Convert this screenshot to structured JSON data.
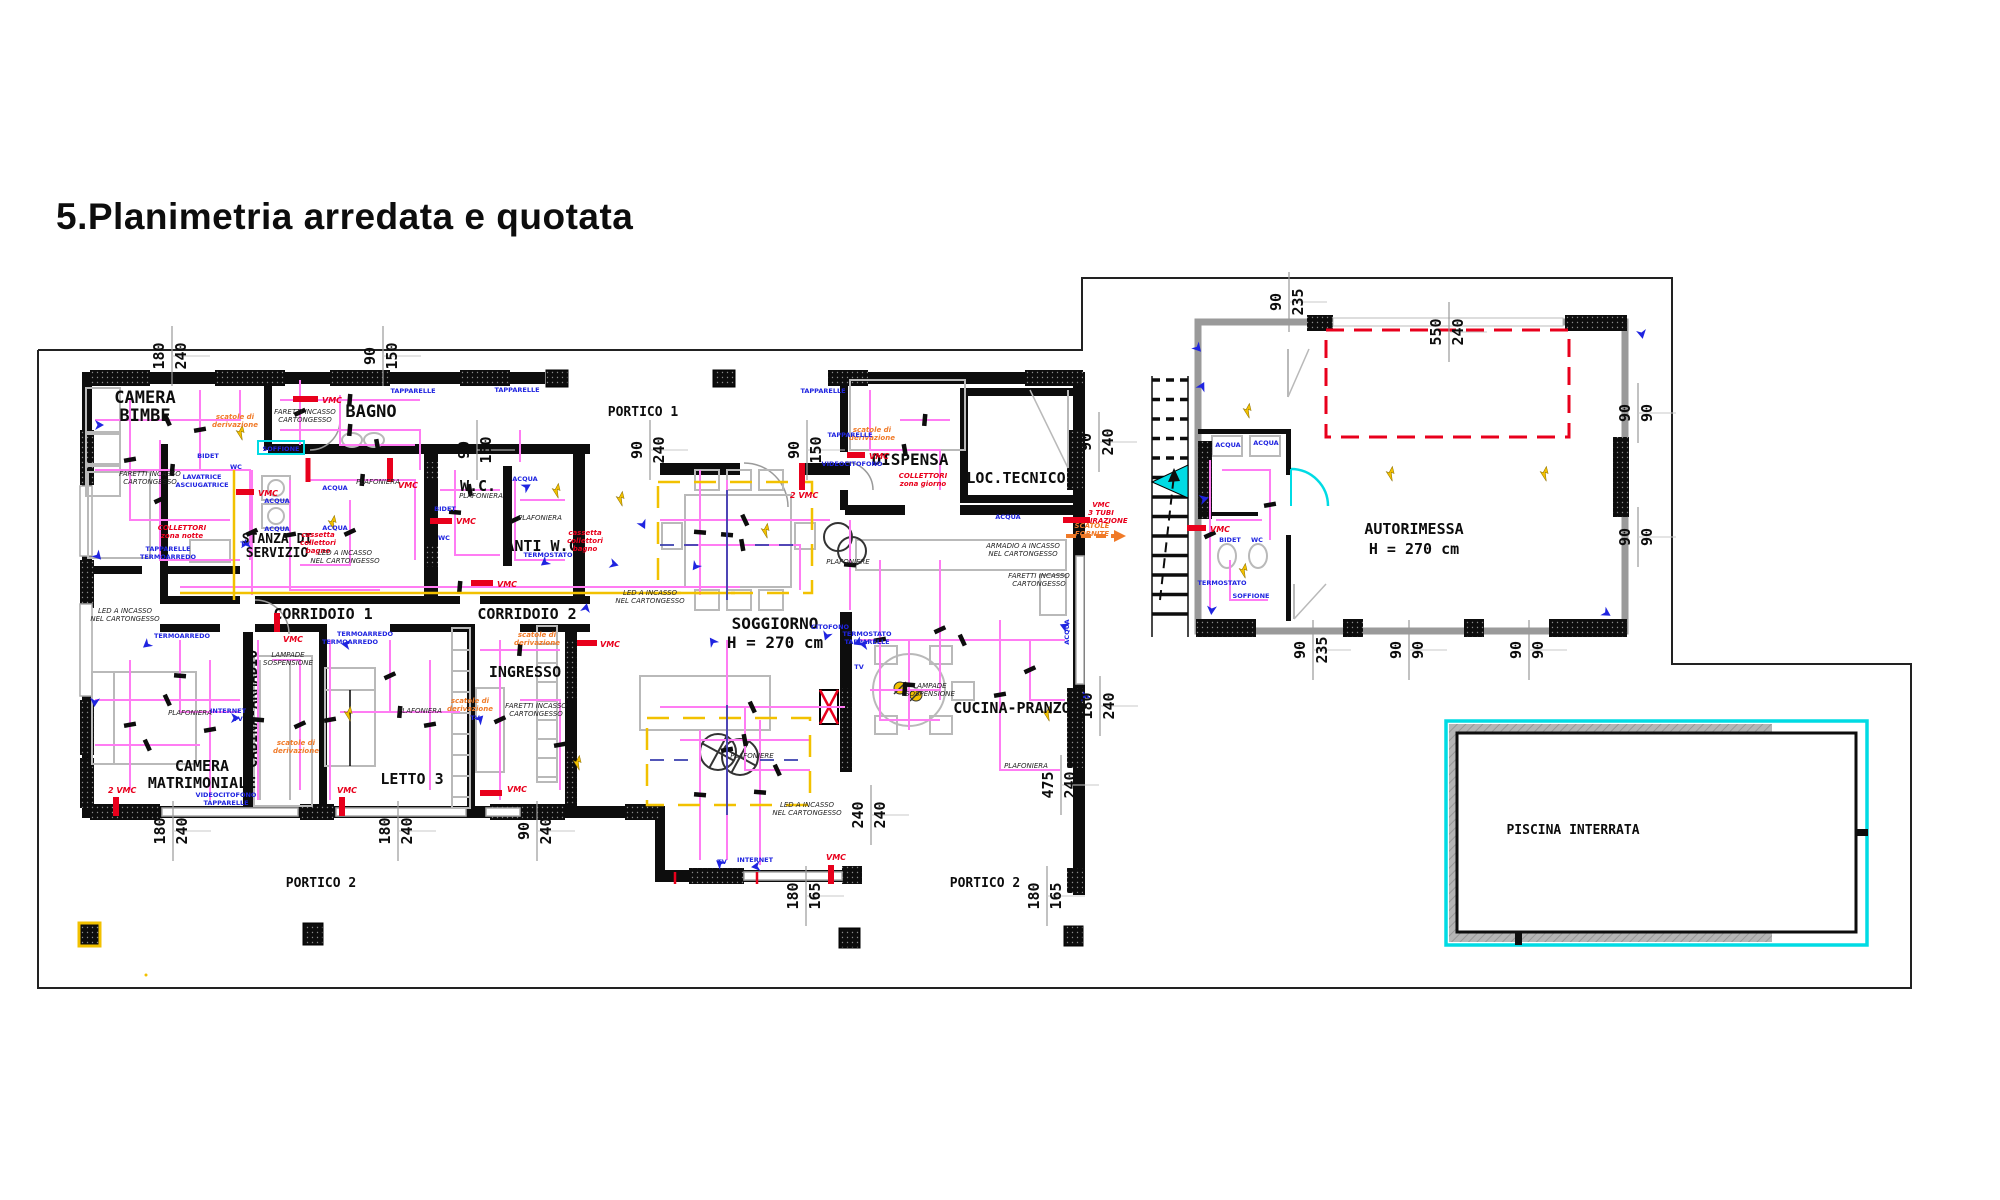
{
  "title": "5.Planimetria arredata e quotata",
  "colors": {
    "wall": "#000000",
    "boundary": "#222222",
    "wire_magenta": "#ff7cf3",
    "red": "#e8001c",
    "orange": "#f07a28",
    "yellow": "#f2c100",
    "blue": "#1f24e0",
    "navy": "#3a3fae",
    "cyan": "#00dbe4",
    "furniture_gray": "#b9b9b9",
    "deck_gray": "#b5b5b5"
  },
  "plan": {
    "rooms": [
      {
        "id": "camera-bimbe",
        "lines": [
          "CAMERA",
          "BIMBE"
        ],
        "x": 145,
        "y": 403,
        "fs": 17,
        "lh": 18
      },
      {
        "id": "bagno",
        "lines": [
          "BAGNO"
        ],
        "x": 371,
        "y": 417,
        "fs": 17
      },
      {
        "id": "wc",
        "lines": [
          "W.C."
        ],
        "x": 478,
        "y": 491,
        "fs": 15
      },
      {
        "id": "anti-wc",
        "lines": [
          "ANTI W.C."
        ],
        "x": 546,
        "y": 551,
        "fs": 15
      },
      {
        "id": "stanza-di-servizio",
        "lines": [
          "STANZA DI",
          "SERVIZIO"
        ],
        "x": 277,
        "y": 543,
        "fs": 13,
        "lh": 14
      },
      {
        "id": "dispensa",
        "lines": [
          "DISPENSA"
        ],
        "x": 910,
        "y": 465,
        "fs": 16
      },
      {
        "id": "loc-tecnico",
        "lines": [
          "LOC.TECNICO"
        ],
        "x": 1016,
        "y": 483,
        "fs": 15
      },
      {
        "id": "corridoio-1",
        "lines": [
          "CORRIDOIO 1"
        ],
        "x": 323,
        "y": 619,
        "fs": 15
      },
      {
        "id": "corridoio-2",
        "lines": [
          "CORRIDOIO 2"
        ],
        "x": 527,
        "y": 619,
        "fs": 15
      },
      {
        "id": "ingresso",
        "lines": [
          "INGRESSO"
        ],
        "x": 525,
        "y": 677,
        "fs": 15
      },
      {
        "id": "soggiorno",
        "lines": [
          "SOGGIORNO",
          "H = 270 cm"
        ],
        "x": 775,
        "y": 629,
        "fs": 16,
        "lh": 19
      },
      {
        "id": "cucina-pranzo",
        "lines": [
          "CUCINA-PRANZO"
        ],
        "x": 1012,
        "y": 713,
        "fs": 15
      },
      {
        "id": "camera-matrimoniale",
        "lines": [
          "CAMERA",
          "MATRIMONIALE"
        ],
        "x": 202,
        "y": 771,
        "fs": 15,
        "lh": 17
      },
      {
        "id": "cabina-armadio",
        "lines": [
          "CABINA-ARMADIO"
        ],
        "x": 257,
        "y": 709,
        "fs": 14,
        "rot": -90
      },
      {
        "id": "letto-3",
        "lines": [
          "LETTO 3"
        ],
        "x": 412,
        "y": 784,
        "fs": 15
      },
      {
        "id": "portico-1",
        "lines": [
          "PORTICO 1"
        ],
        "x": 643,
        "y": 416,
        "fs": 13
      },
      {
        "id": "portico-2-sx",
        "lines": [
          "PORTICO 2"
        ],
        "x": 321,
        "y": 887,
        "fs": 13
      },
      {
        "id": "portico-2-dx",
        "lines": [
          "PORTICO 2"
        ],
        "x": 985,
        "y": 887,
        "fs": 13
      },
      {
        "id": "autorimessa",
        "lines": [
          "AUTORIMESSA",
          "H = 270 cm"
        ],
        "x": 1414,
        "y": 534,
        "fs": 15,
        "lh": 20
      },
      {
        "id": "piscina-interrata",
        "lines": [
          "PISCINA INTERRATA"
        ],
        "x": 1573,
        "y": 834,
        "fs": 13
      }
    ],
    "dims": [
      {
        "a": "180",
        "b": "240",
        "x": 170,
        "y": 356
      },
      {
        "a": "90",
        "b": "150",
        "x": 381,
        "y": 356
      },
      {
        "a": "90",
        "b": "150",
        "x": 475,
        "y": 450
      },
      {
        "a": "90",
        "b": "240",
        "x": 648,
        "y": 450
      },
      {
        "a": "90",
        "b": "150",
        "x": 805,
        "y": 450
      },
      {
        "a": "90",
        "b": "240",
        "x": 1097,
        "y": 442
      },
      {
        "a": "90",
        "b": "235",
        "x": 1287,
        "y": 302
      },
      {
        "a": "550",
        "b": "240",
        "x": 1447,
        "y": 332
      },
      {
        "a": "90",
        "b": "90",
        "x": 1636,
        "y": 413
      },
      {
        "a": "90",
        "b": "90",
        "x": 1636,
        "y": 537
      },
      {
        "a": "90",
        "b": "235",
        "x": 1311,
        "y": 650
      },
      {
        "a": "90",
        "b": "90",
        "x": 1407,
        "y": 650
      },
      {
        "a": "90",
        "b": "90",
        "x": 1527,
        "y": 650
      },
      {
        "a": "180",
        "b": "240",
        "x": 1098,
        "y": 706
      },
      {
        "a": "475",
        "b": "240",
        "x": 1059,
        "y": 785
      },
      {
        "a": "240",
        "b": "240",
        "x": 869,
        "y": 815
      },
      {
        "a": "180",
        "b": "165",
        "x": 804,
        "y": 896
      },
      {
        "a": "180",
        "b": "165",
        "x": 1045,
        "y": 896
      },
      {
        "a": "180",
        "b": "240",
        "x": 171,
        "y": 831
      },
      {
        "a": "180",
        "b": "240",
        "x": 396,
        "y": 831
      },
      {
        "a": "90",
        "b": "240",
        "x": 535,
        "y": 831
      }
    ],
    "vmc": [
      {
        "label": "VMC",
        "x": 322,
        "y": 403,
        "bar": [
          293,
          399,
          318,
          399
        ]
      },
      {
        "label": "VMC",
        "x": 398,
        "y": 488,
        "bar": [
          390,
          458,
          390,
          482
        ]
      },
      {
        "label": "VMC",
        "x": 258,
        "y": 496,
        "bar": [
          236,
          492,
          254,
          492
        ]
      },
      {
        "label": "VMC",
        "x": 456,
        "y": 524,
        "bar": [
          430,
          521,
          452,
          521
        ]
      },
      {
        "label": "VMC",
        "x": 497,
        "y": 587,
        "bar": [
          471,
          583,
          493,
          583
        ]
      },
      {
        "label": "VMC",
        "x": 600,
        "y": 647,
        "bar": [
          577,
          643,
          597,
          643
        ]
      },
      {
        "label": "2 VMC",
        "x": 790,
        "y": 498,
        "bar": [
          802,
          463,
          802,
          490
        ]
      },
      {
        "label": "VMC",
        "x": 869,
        "y": 459,
        "bar": [
          847,
          455,
          865,
          455
        ]
      },
      {
        "label": "2 VMC",
        "x": 108,
        "y": 793,
        "bar": [
          116,
          797,
          116,
          816
        ]
      },
      {
        "label": "VMC",
        "x": 337,
        "y": 793,
        "bar": [
          342,
          797,
          342,
          816
        ]
      },
      {
        "label": "VMC",
        "x": 507,
        "y": 792,
        "bar": [
          480,
          793,
          502,
          793
        ]
      },
      {
        "label": "VMC",
        "x": 826,
        "y": 860,
        "bar": [
          831,
          865,
          831,
          884
        ]
      },
      {
        "label": "VMC",
        "x": 283,
        "y": 642,
        "bar": [
          277,
          613,
          277,
          632
        ]
      },
      {
        "label": "VMC",
        "x": 1210,
        "y": 532,
        "bar": [
          1187,
          528,
          1206,
          528
        ]
      }
    ],
    "notes_red": [
      {
        "lines": [
          "COLLETTORI",
          "zona notte"
        ],
        "x": 182,
        "y": 530
      },
      {
        "lines": [
          "cassetta",
          "collettori",
          "bagno"
        ],
        "x": 318,
        "y": 537
      },
      {
        "lines": [
          "cassetta",
          "collettori",
          "bagno"
        ],
        "x": 585,
        "y": 535
      },
      {
        "lines": [
          "COLLETTORI",
          "zona giorno"
        ],
        "x": 923,
        "y": 478
      },
      {
        "lines": [
          "VMC",
          "3 TUBI",
          "ASPIRAZIONE"
        ],
        "x": 1101,
        "y": 507
      }
    ],
    "notes_orange": [
      {
        "lines": [
          "scatole di",
          "derivazione"
        ],
        "x": 235,
        "y": 419
      },
      {
        "lines": [
          "scatole di",
          "derivazione"
        ],
        "x": 872,
        "y": 432
      },
      {
        "lines": [
          "scatole di",
          "derivazione"
        ],
        "x": 537,
        "y": 637
      },
      {
        "lines": [
          "scatole di",
          "derivazione"
        ],
        "x": 296,
        "y": 745
      },
      {
        "lines": [
          "scatole di",
          "derivazione"
        ],
        "x": 470,
        "y": 703
      },
      {
        "lines": [
          "SCATOLE",
          "FORNITE"
        ],
        "x": 1092,
        "y": 528
      }
    ],
    "notes_black": [
      {
        "lines": [
          "FARETTI INCASSO",
          "CARTONGESSO"
        ],
        "x": 150,
        "y": 476
      },
      {
        "lines": [
          "FARETTI INCASSO",
          "CARTONGESSO"
        ],
        "x": 305,
        "y": 414
      },
      {
        "lines": [
          "FARETTI INCASSO",
          "CARTONGESSO"
        ],
        "x": 536,
        "y": 708
      },
      {
        "lines": [
          "FARETTI INCASSO",
          "CARTONGESSO"
        ],
        "x": 1039,
        "y": 578
      },
      {
        "lines": [
          "ARMADIO A INCASSO",
          "NEL CARTONGESSO"
        ],
        "x": 1023,
        "y": 548
      },
      {
        "lines": [
          "LED A INCASSO",
          "NEL CARTONGESSO"
        ],
        "x": 125,
        "y": 613
      },
      {
        "lines": [
          "LED A INCASSO",
          "NEL CARTONGESSO"
        ],
        "x": 650,
        "y": 595
      },
      {
        "lines": [
          "LED A INCASSO",
          "NEL CARTONGESSO"
        ],
        "x": 807,
        "y": 807
      },
      {
        "lines": [
          "LED A INCASSO",
          "NEL CARTONGESSO"
        ],
        "x": 345,
        "y": 555
      },
      {
        "lines": [
          "LAMPADE",
          "SOSPENSIONE"
        ],
        "x": 288,
        "y": 657
      },
      {
        "lines": [
          "LAMPADE",
          "SOSPENSIONE"
        ],
        "x": 930,
        "y": 688
      },
      {
        "lines": [
          "PLAFONIERA"
        ],
        "x": 190,
        "y": 715
      },
      {
        "lines": [
          "PLAFONIERA"
        ],
        "x": 420,
        "y": 713
      },
      {
        "lines": [
          "PLAFONIERA"
        ],
        "x": 481,
        "y": 498
      },
      {
        "lines": [
          "PLAFONIERA"
        ],
        "x": 540,
        "y": 520
      },
      {
        "lines": [
          "PLAFONIERA"
        ],
        "x": 378,
        "y": 484
      },
      {
        "lines": [
          "PLAFONIERE"
        ],
        "x": 848,
        "y": 564
      },
      {
        "lines": [
          "PLAFONIERE"
        ],
        "x": 752,
        "y": 758
      },
      {
        "lines": [
          "PLAFONIERA"
        ],
        "x": 1026,
        "y": 768
      }
    ],
    "labels_blue": [
      {
        "t": "LAVATRICE",
        "x": 202,
        "y": 479
      },
      {
        "t": "ASCIUGATRICE",
        "x": 202,
        "y": 487
      },
      {
        "t": "ACQUA",
        "x": 277,
        "y": 503
      },
      {
        "t": "ACQUA",
        "x": 277,
        "y": 531
      },
      {
        "t": "ACQUA",
        "x": 335,
        "y": 490
      },
      {
        "t": "ACQUA",
        "x": 335,
        "y": 530
      },
      {
        "t": "ACQUA",
        "x": 525,
        "y": 481
      },
      {
        "t": "ACQUA",
        "x": 1008,
        "y": 519
      },
      {
        "t": "ACQUA",
        "x": 1228,
        "y": 447
      },
      {
        "t": "ACQUA",
        "x": 1266,
        "y": 445
      },
      {
        "t": "ACQUA",
        "x": 1069,
        "y": 632,
        "rot": -90
      },
      {
        "t": "BIDET",
        "x": 208,
        "y": 458
      },
      {
        "t": "BIDET",
        "x": 445,
        "y": 511
      },
      {
        "t": "BIDET",
        "x": 1230,
        "y": 542
      },
      {
        "t": "WC",
        "x": 236,
        "y": 469
      },
      {
        "t": "WC",
        "x": 444,
        "y": 540
      },
      {
        "t": "WC",
        "x": 1257,
        "y": 542
      },
      {
        "t": "SOFFIONE",
        "x": 281,
        "y": 451
      },
      {
        "t": "SOFFIONE",
        "x": 1251,
        "y": 598
      },
      {
        "t": "TAPPARELLE",
        "x": 168,
        "y": 551
      },
      {
        "t": "TERMOARREDO",
        "x": 168,
        "y": 559
      },
      {
        "t": "TERMOARREDO",
        "x": 182,
        "y": 638
      },
      {
        "t": "TERMOARREDO",
        "x": 365,
        "y": 636
      },
      {
        "t": "TERMOARREDO",
        "x": 350,
        "y": 644
      },
      {
        "t": "TERMOSTATO",
        "x": 548,
        "y": 557
      },
      {
        "t": "TERMOSTATO",
        "x": 867,
        "y": 636
      },
      {
        "t": "TAPPARELLE",
        "x": 867,
        "y": 644
      },
      {
        "t": "TAPPARELLE",
        "x": 850,
        "y": 437
      },
      {
        "t": "TAPPARELLE",
        "x": 413,
        "y": 393
      },
      {
        "t": "TAPPARELLE",
        "x": 517,
        "y": 392
      },
      {
        "t": "TAPPARELLE",
        "x": 823,
        "y": 393
      },
      {
        "t": "VIDEOCITOFONO",
        "x": 226,
        "y": 797
      },
      {
        "t": "TAPPARELLE",
        "x": 226,
        "y": 805
      },
      {
        "t": "VIDEOCITOFONO",
        "x": 852,
        "y": 466
      },
      {
        "t": "CITOFONO",
        "x": 830,
        "y": 629
      },
      {
        "t": "INTERNET",
        "x": 755,
        "y": 862
      },
      {
        "t": "INTERNET",
        "x": 228,
        "y": 713
      },
      {
        "t": "TV",
        "x": 238,
        "y": 721
      },
      {
        "t": "TV",
        "x": 475,
        "y": 720
      },
      {
        "t": "TV",
        "x": 722,
        "y": 864
      },
      {
        "t": "TV",
        "x": 859,
        "y": 669
      },
      {
        "t": "TV",
        "x": 245,
        "y": 546
      },
      {
        "t": "TERMOSTATO",
        "x": 1222,
        "y": 585
      }
    ]
  }
}
